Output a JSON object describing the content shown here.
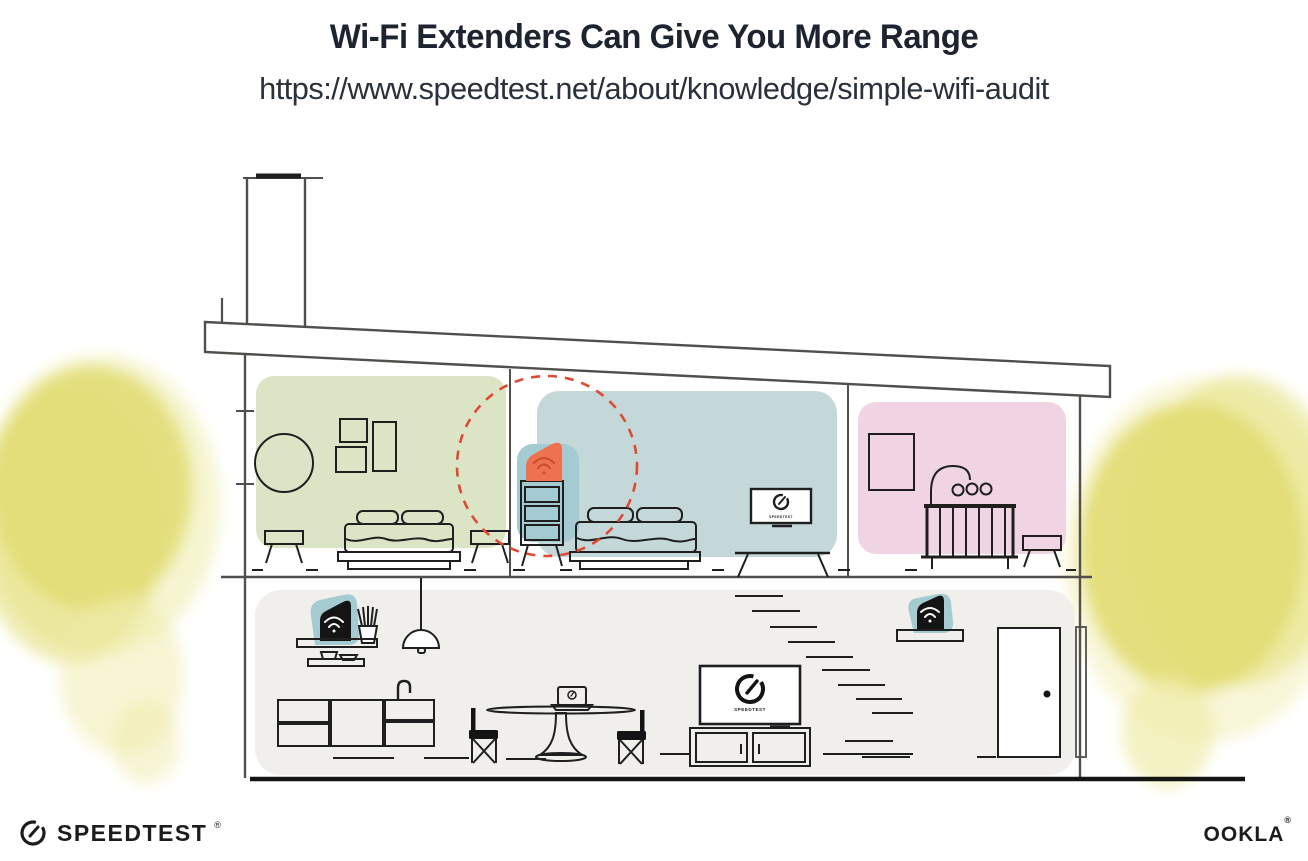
{
  "header": {
    "title": "Wi-Fi Extenders Can Give You More Range",
    "url": "https://www.speedtest.net/about/knowledge/simple-wifi-audit"
  },
  "illustration": {
    "upstairs_tv_label": "SPEEDTEST",
    "living_tv_label": "SPEEDTEST"
  },
  "footer": {
    "speedtest_wordmark": "SPEEDTEST",
    "speedtest_mark": "®",
    "ookla_wordmark": "OOKLA",
    "ookla_mark": "®"
  },
  "icons": {
    "gauge": "speedtest-gauge-icon",
    "wifi": "wifi-arcs-icon"
  },
  "colors": {
    "canvas": "#ffffff",
    "title_text": "#1d2430",
    "url_text": "#2a313c",
    "line_gray": "#504f4b",
    "ink": "#1f1f1f",
    "green_room": "#dbe5c6",
    "blue_room": "#c4d8da",
    "pink_room": "#f0d4e4",
    "ground_floor": "#f0efec",
    "teal_blob": "#a4cad2",
    "extender_orange": "#ee7150",
    "wifi_orange": "#c95030",
    "range_red": "#de4a33",
    "bush_yellow": "#e2dd72",
    "bush_yellow_light": "#efeca9",
    "device_black": "#141414",
    "logo_black": "#1c1c1c"
  }
}
